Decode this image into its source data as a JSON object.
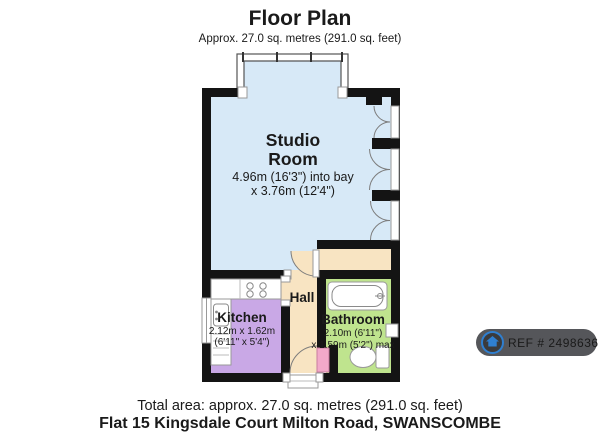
{
  "header": {
    "title": "Floor Plan",
    "subtitle": "Approx. 27.0 sq. metres (291.0 sq. feet)"
  },
  "rooms": {
    "studio": {
      "name_line1": "Studio",
      "name_line2": "Room",
      "dims_line1": "4.96m (16'3\") into bay",
      "dims_line2": "x 3.76m (12'4\")",
      "floor_color": "#d7e9f7"
    },
    "kitchen": {
      "name": "Kitchen",
      "dims_line1": "2.12m x 1.62m",
      "dims_line2": "(6'11\" x 5'4\")",
      "floor_color": "#c9a8e6"
    },
    "hall": {
      "name": "Hall",
      "floor_color": "#f8e4c2"
    },
    "bathroom": {
      "name": "Bathroom",
      "dims_line1": "2.10m (6'11\")",
      "dims_line2": "x 1.59m (5'2\") max",
      "floor_color": "#bfe48e"
    }
  },
  "doors": {
    "bathroom_door_color": "#f2a9c9"
  },
  "footer": {
    "total_area": "Total area: approx. 27.0 sq. metres (291.0 sq. feet)",
    "address": "Flat 15 Kingsdale Court Milton Road, SWANSCOMBE"
  },
  "ref_badge": {
    "label": "REF # 2498636",
    "icon": "house-icon",
    "bg_color": "#55565a",
    "icon_color": "#2f7fd0",
    "text_color": "#ededed"
  }
}
